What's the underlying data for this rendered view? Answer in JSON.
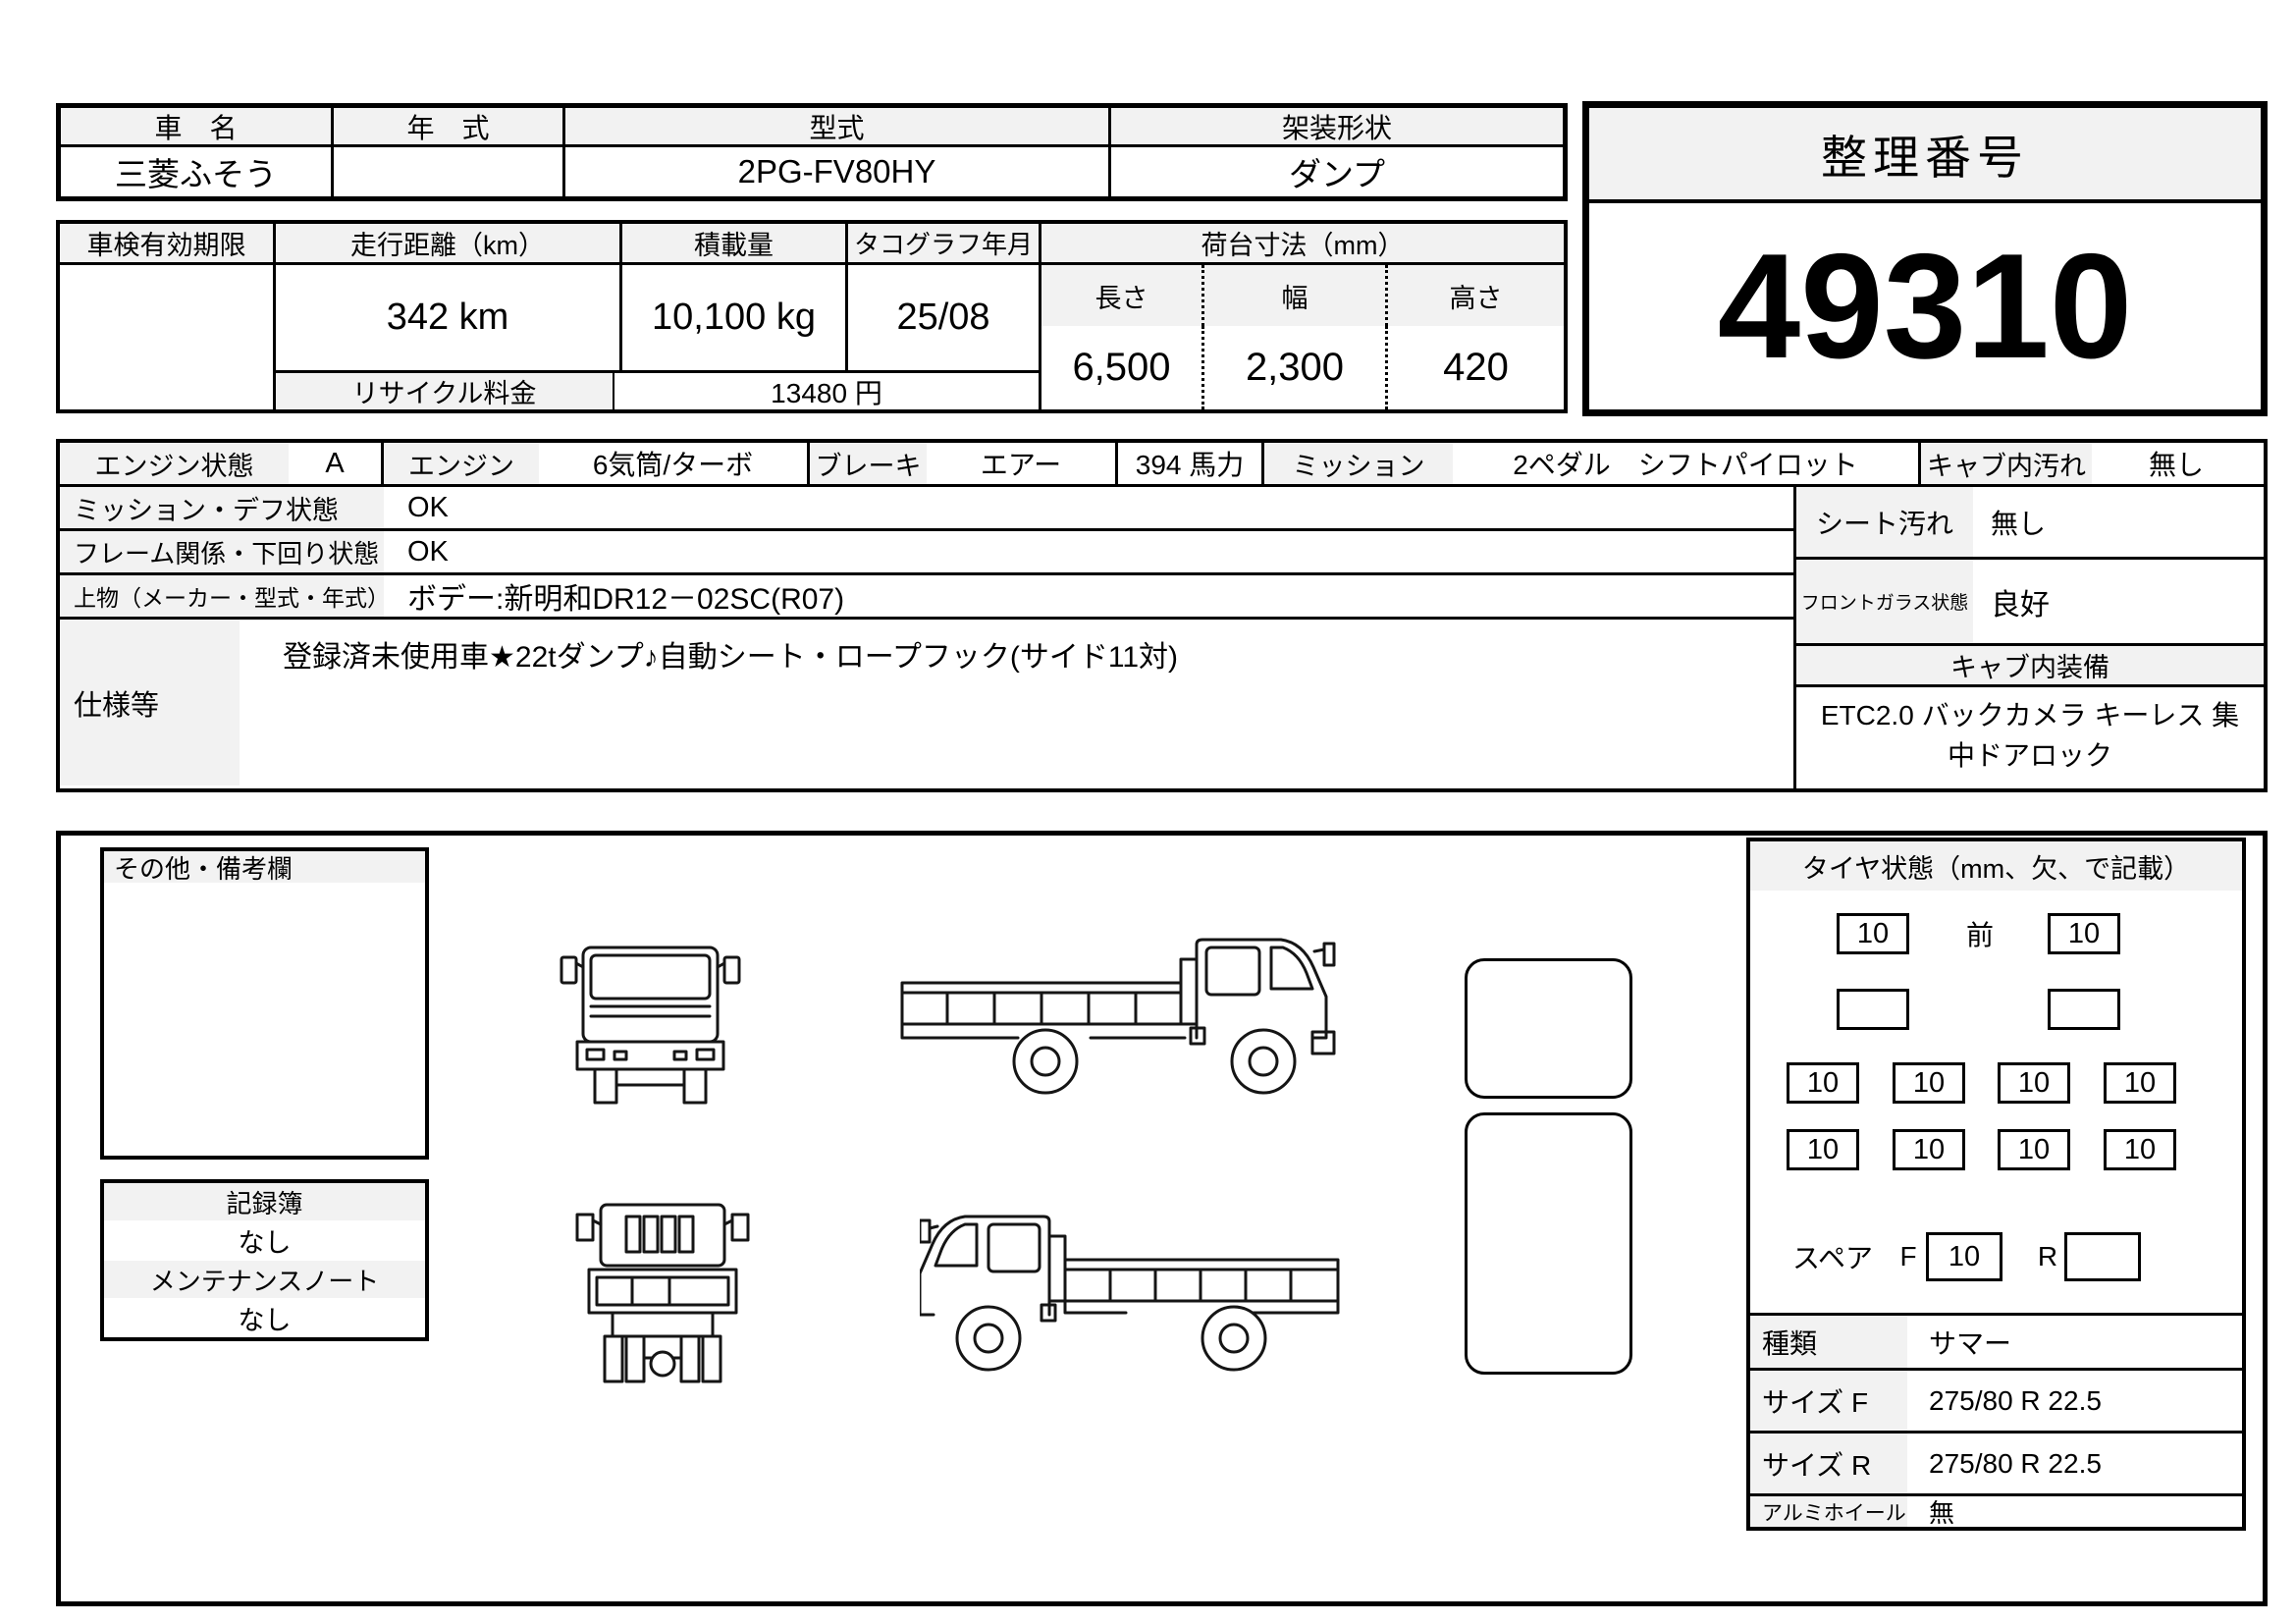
{
  "title_table": {
    "car_name_label": "車　名",
    "car_name": "三菱ふそう",
    "year_label": "年　式",
    "year": "",
    "model_label": "型式",
    "model": "2PG-FV80HY",
    "body_style_label": "架装形状",
    "body_style": "ダンプ"
  },
  "serial": {
    "label": "整理番号",
    "number": "49310"
  },
  "spec_table": {
    "shaken_label": "車検有効期限",
    "shaken": "",
    "mileage_label": "走行距離（km）",
    "mileage": "342 km",
    "payload_label": "積載量",
    "payload": "10,100 kg",
    "tachograph_label": "タコグラフ年月",
    "tachograph": "25/08",
    "bed_label": "荷台寸法（mm）",
    "length_label": "長さ",
    "length": "6,500",
    "width_label": "幅",
    "width": "2,300",
    "height_label": "高さ",
    "height": "420",
    "recycle_label": "リサイクル料金",
    "recycle": "13480 円"
  },
  "condition": {
    "engine_state_label": "エンジン状態",
    "engine_state": "A",
    "engine_label": "エンジン",
    "engine": "6気筒/ターボ",
    "brake_label": "ブレーキ",
    "brake": "エアー",
    "power": "394 馬力",
    "transmission_label": "ミッション",
    "transmission": "2ペダル　シフトパイロット",
    "cab_dirt_label": "キャブ内汚れ",
    "cab_dirt": "無し",
    "mission_diff_label": "ミッション・デフ状態",
    "mission_diff": "OK",
    "frame_label": "フレーム関係・下回り状態",
    "frame": "OK",
    "body_label": "上物（メーカー・型式・年式）",
    "body": "ボデー:新明和DR12－02SC(R07)",
    "spec_label": "仕様等",
    "spec": "登録済未使用車★22tダンプ♪自動シート・ロープフック(サイド11対)",
    "seat_label": "シート汚れ",
    "seat": "無し",
    "windshield_label": "フロントガラス状態",
    "windshield": "良好",
    "cab_equipment_label": "キャブ内装備",
    "cab_equipment": "ETC2.0 バックカメラ キーレス 集中ドアロック"
  },
  "remarks": {
    "notes_title": "その他・備考欄",
    "record_label": "記録簿",
    "record": "なし",
    "maintenance_label": "メンテナンスノート",
    "maintenance": "なし"
  },
  "tires": {
    "title": "タイヤ状態（mm、欠、で記載）",
    "front_label": "前",
    "front_left": "10",
    "front_right": "10",
    "mid_left": "",
    "mid_right": "",
    "rear_row1": [
      "10",
      "10",
      "10",
      "10"
    ],
    "rear_row2": [
      "10",
      "10",
      "10",
      "10"
    ],
    "spare_label": "スペア",
    "spare_f_label": "F",
    "spare_f": "10",
    "spare_r_label": "R",
    "spare_r": "",
    "type_label": "種類",
    "type": "サマー",
    "size_f_label": "サイズ F",
    "size_f": "275/80 R 22.5",
    "size_r_label": "サイズ R",
    "size_r": "275/80 R 22.5",
    "alloy_label": "アルミホイール",
    "alloy": "無"
  },
  "colors": {
    "header_bg": "#f2f2f2",
    "border": "#000000"
  }
}
